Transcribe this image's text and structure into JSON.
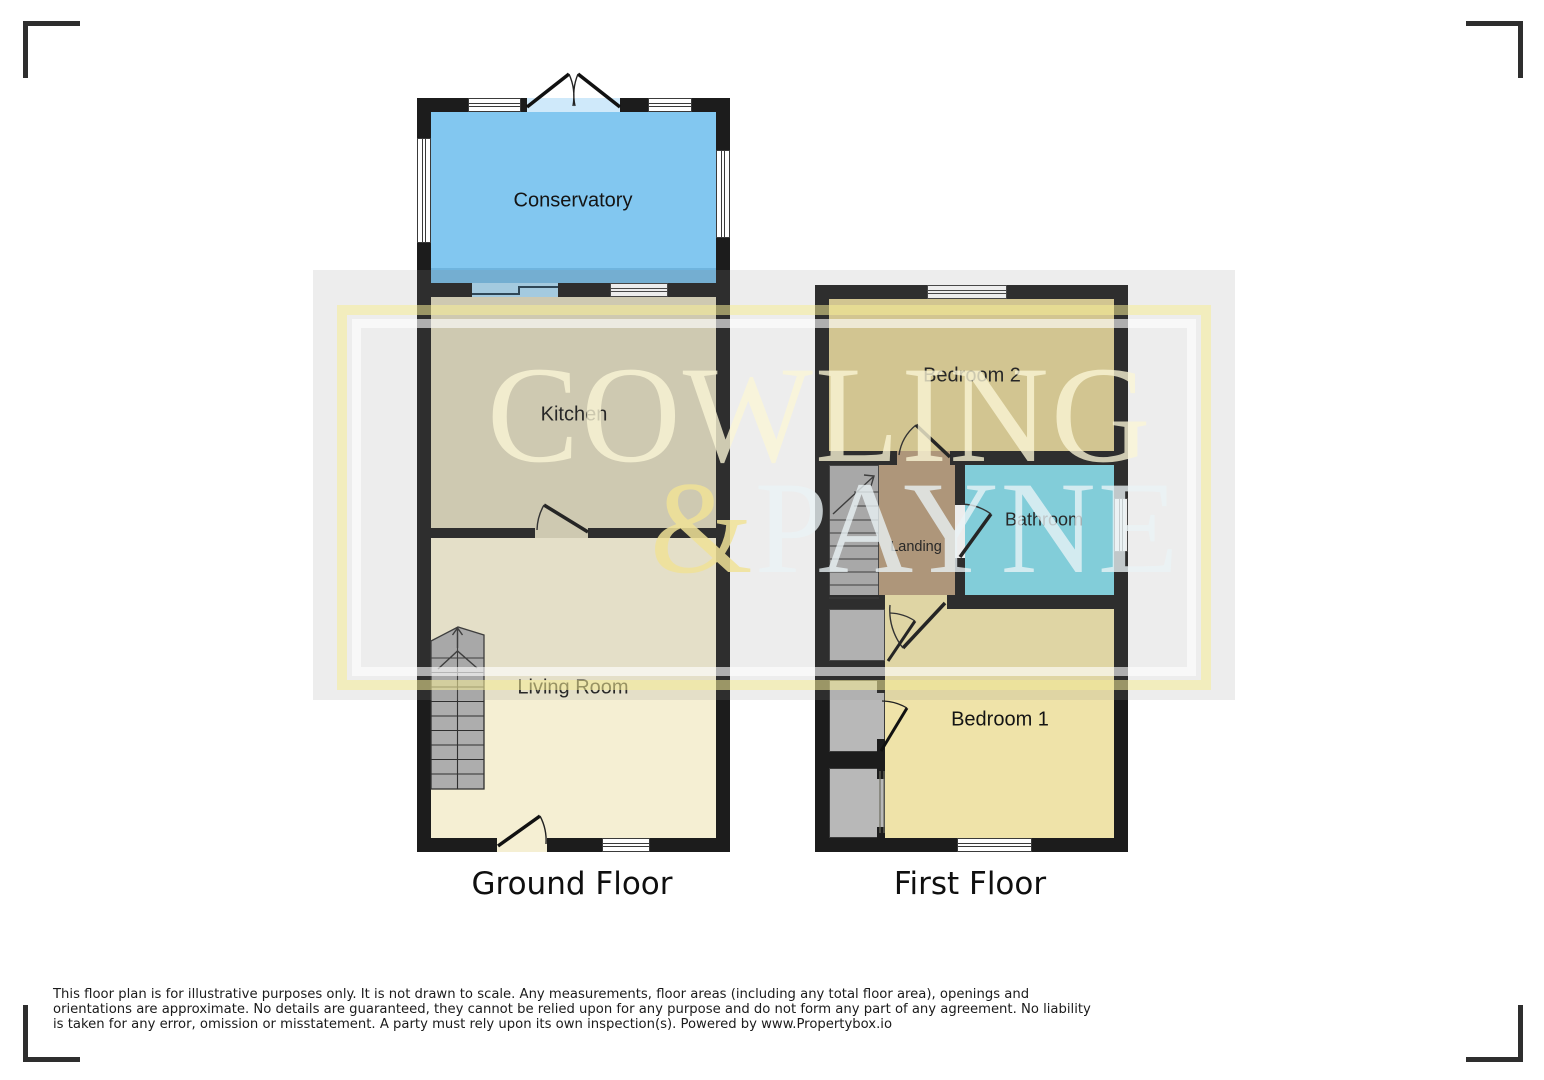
{
  "watermark": {
    "line1": "COWLING",
    "ampersand": "&",
    "line2": "PAYNE"
  },
  "ground_floor": {
    "title": "Ground Floor",
    "rooms": {
      "conservatory": "Conservatory",
      "kitchen": "Kitchen",
      "living_room": "Living Room"
    }
  },
  "first_floor": {
    "title": "First Floor",
    "rooms": {
      "bedroom2": "Bedroom 2",
      "bathroom": "Bathroom",
      "landing": "Landing",
      "bedroom1": "Bedroom 1"
    }
  },
  "footer": {
    "disclaimer": "This floor plan is for illustrative purposes only. It is not drawn to scale. Any measurements, floor areas (including any total floor area), openings and orientations are approximate. No details are guaranteed, they cannot be relied upon for any purpose and do not form any part of any agreement. No liability is taken for any error, omission or misstatement. A party must rely upon its own inspection(s). Powered by www.Propertybox.io"
  },
  "colors": {
    "wall": "#1c1c1c",
    "conservatory": "#82c7f0",
    "kitchen": "#dbd4b8",
    "living_room": "#f5efd3",
    "bedroom2": "#dfd092",
    "bedroom1": "#efe3a9",
    "bathroom": "#80d9e8",
    "landing": "#b49877",
    "stairs": "#adadad",
    "watermark_gold": "#f7ee96"
  }
}
